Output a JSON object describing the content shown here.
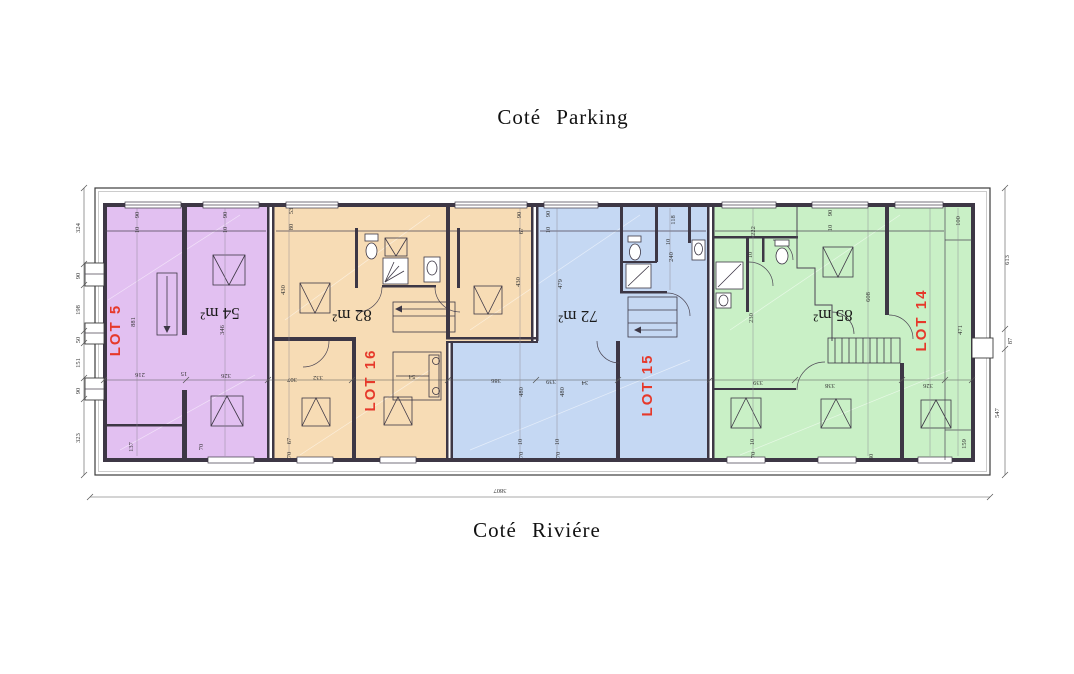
{
  "titles": {
    "top": "Coté Parking",
    "bottom": "Coté Riviére"
  },
  "lots": [
    {
      "name": "LOT 5",
      "area": "54 m²",
      "fill": "#e2c0f1"
    },
    {
      "name": "LOT 16",
      "area": "82 m²",
      "fill": "#f7dcb5"
    },
    {
      "name": "LOT 15",
      "area": "72 m²",
      "fill": "#c5d8f3"
    },
    {
      "name": "LOT 14",
      "area": "85 m²",
      "fill": "#c9f0c6"
    }
  ],
  "colors": {
    "lot_label": "#e6392b",
    "walls": "#3d3745"
  },
  "dims": {
    "left": [
      "324",
      "90",
      "198",
      "50",
      "151",
      "90",
      "323"
    ],
    "right": [
      "613",
      "87",
      "547"
    ],
    "total": "3807",
    "lot5": {
      "t1": "90",
      "t2": "10",
      "t3": "90",
      "t4": "10",
      "v1": "881",
      "v2": "346",
      "c1": "216",
      "c2": "15",
      "c3": "326",
      "b1": "137",
      "b2": "70"
    },
    "lot16": {
      "t1": "53",
      "t2": "80",
      "t3": "90",
      "t4": "67",
      "v1": "430",
      "v2": "430",
      "c1": "307",
      "c2": "332",
      "c3": "54",
      "b1": "67",
      "b2": "70"
    },
    "lot15": {
      "t1": "90",
      "t2": "10",
      "t3": "118",
      "t4": "10",
      "t5": "240",
      "v1": "479",
      "v2": "480",
      "v3": "480",
      "c1": "386",
      "c2": "339",
      "c3": "34",
      "b1": "10",
      "b2": "70",
      "b3": "10",
      "b4": "70"
    },
    "lot14": {
      "t1": "222",
      "t2": "10",
      "t3": "90",
      "t4": "10",
      "t5": "100",
      "v1": "230",
      "v2": "608",
      "v3": "471",
      "c1": "339",
      "c2": "338",
      "c3": "326",
      "b1": "10",
      "b2": "70",
      "b3": "80",
      "b4": "159"
    }
  }
}
